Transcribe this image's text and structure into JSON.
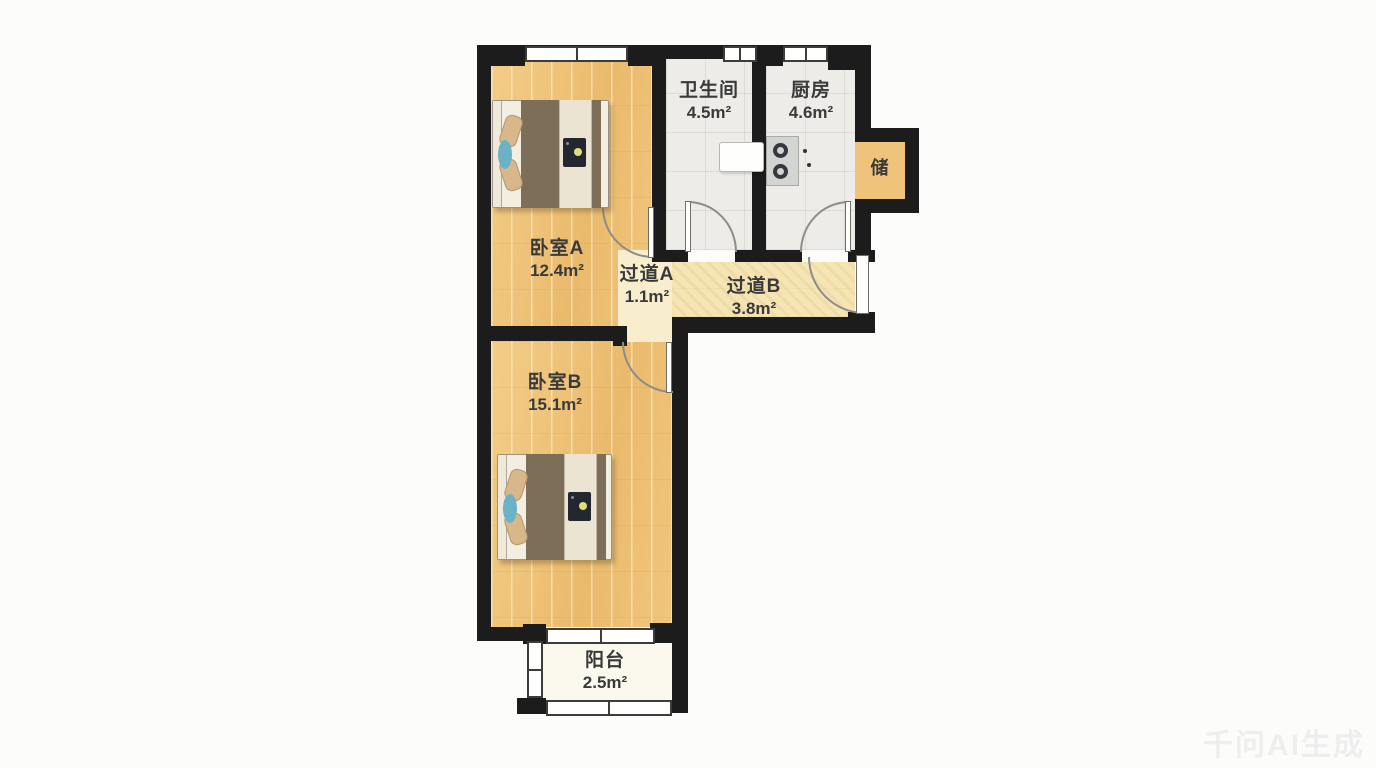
{
  "watermark": "千问AI生成",
  "plan": {
    "type": "apartment-floor-plan",
    "rooms": [
      {
        "name": "卧室A",
        "area": "12.4m²"
      },
      {
        "name": "卫生间",
        "area": "4.5m²"
      },
      {
        "name": "厨房",
        "area": "4.6m²"
      },
      {
        "name": "储",
        "area": ""
      },
      {
        "name": "过道A",
        "area": "1.1m²"
      },
      {
        "name": "过道B",
        "area": "3.8m²"
      },
      {
        "name": "卧室B",
        "area": "15.1m²"
      },
      {
        "name": "阳台",
        "area": "2.5m²"
      }
    ],
    "colors": {
      "wall": "#1c1c1c",
      "wood_floor": "#edc077",
      "tile_floor": "#edece8",
      "corridor_b_floor": "#f5e5b5",
      "corridor_a_floor": "#f8eecd",
      "storage_floor": "#efc379",
      "balcony_floor": "#fbf8ee",
      "label_text": "#3a3a3a",
      "duvet_brown": "#7c6e57",
      "pillow_tan": "#d8b88b",
      "accent_blue": "#6cb2c6"
    }
  }
}
